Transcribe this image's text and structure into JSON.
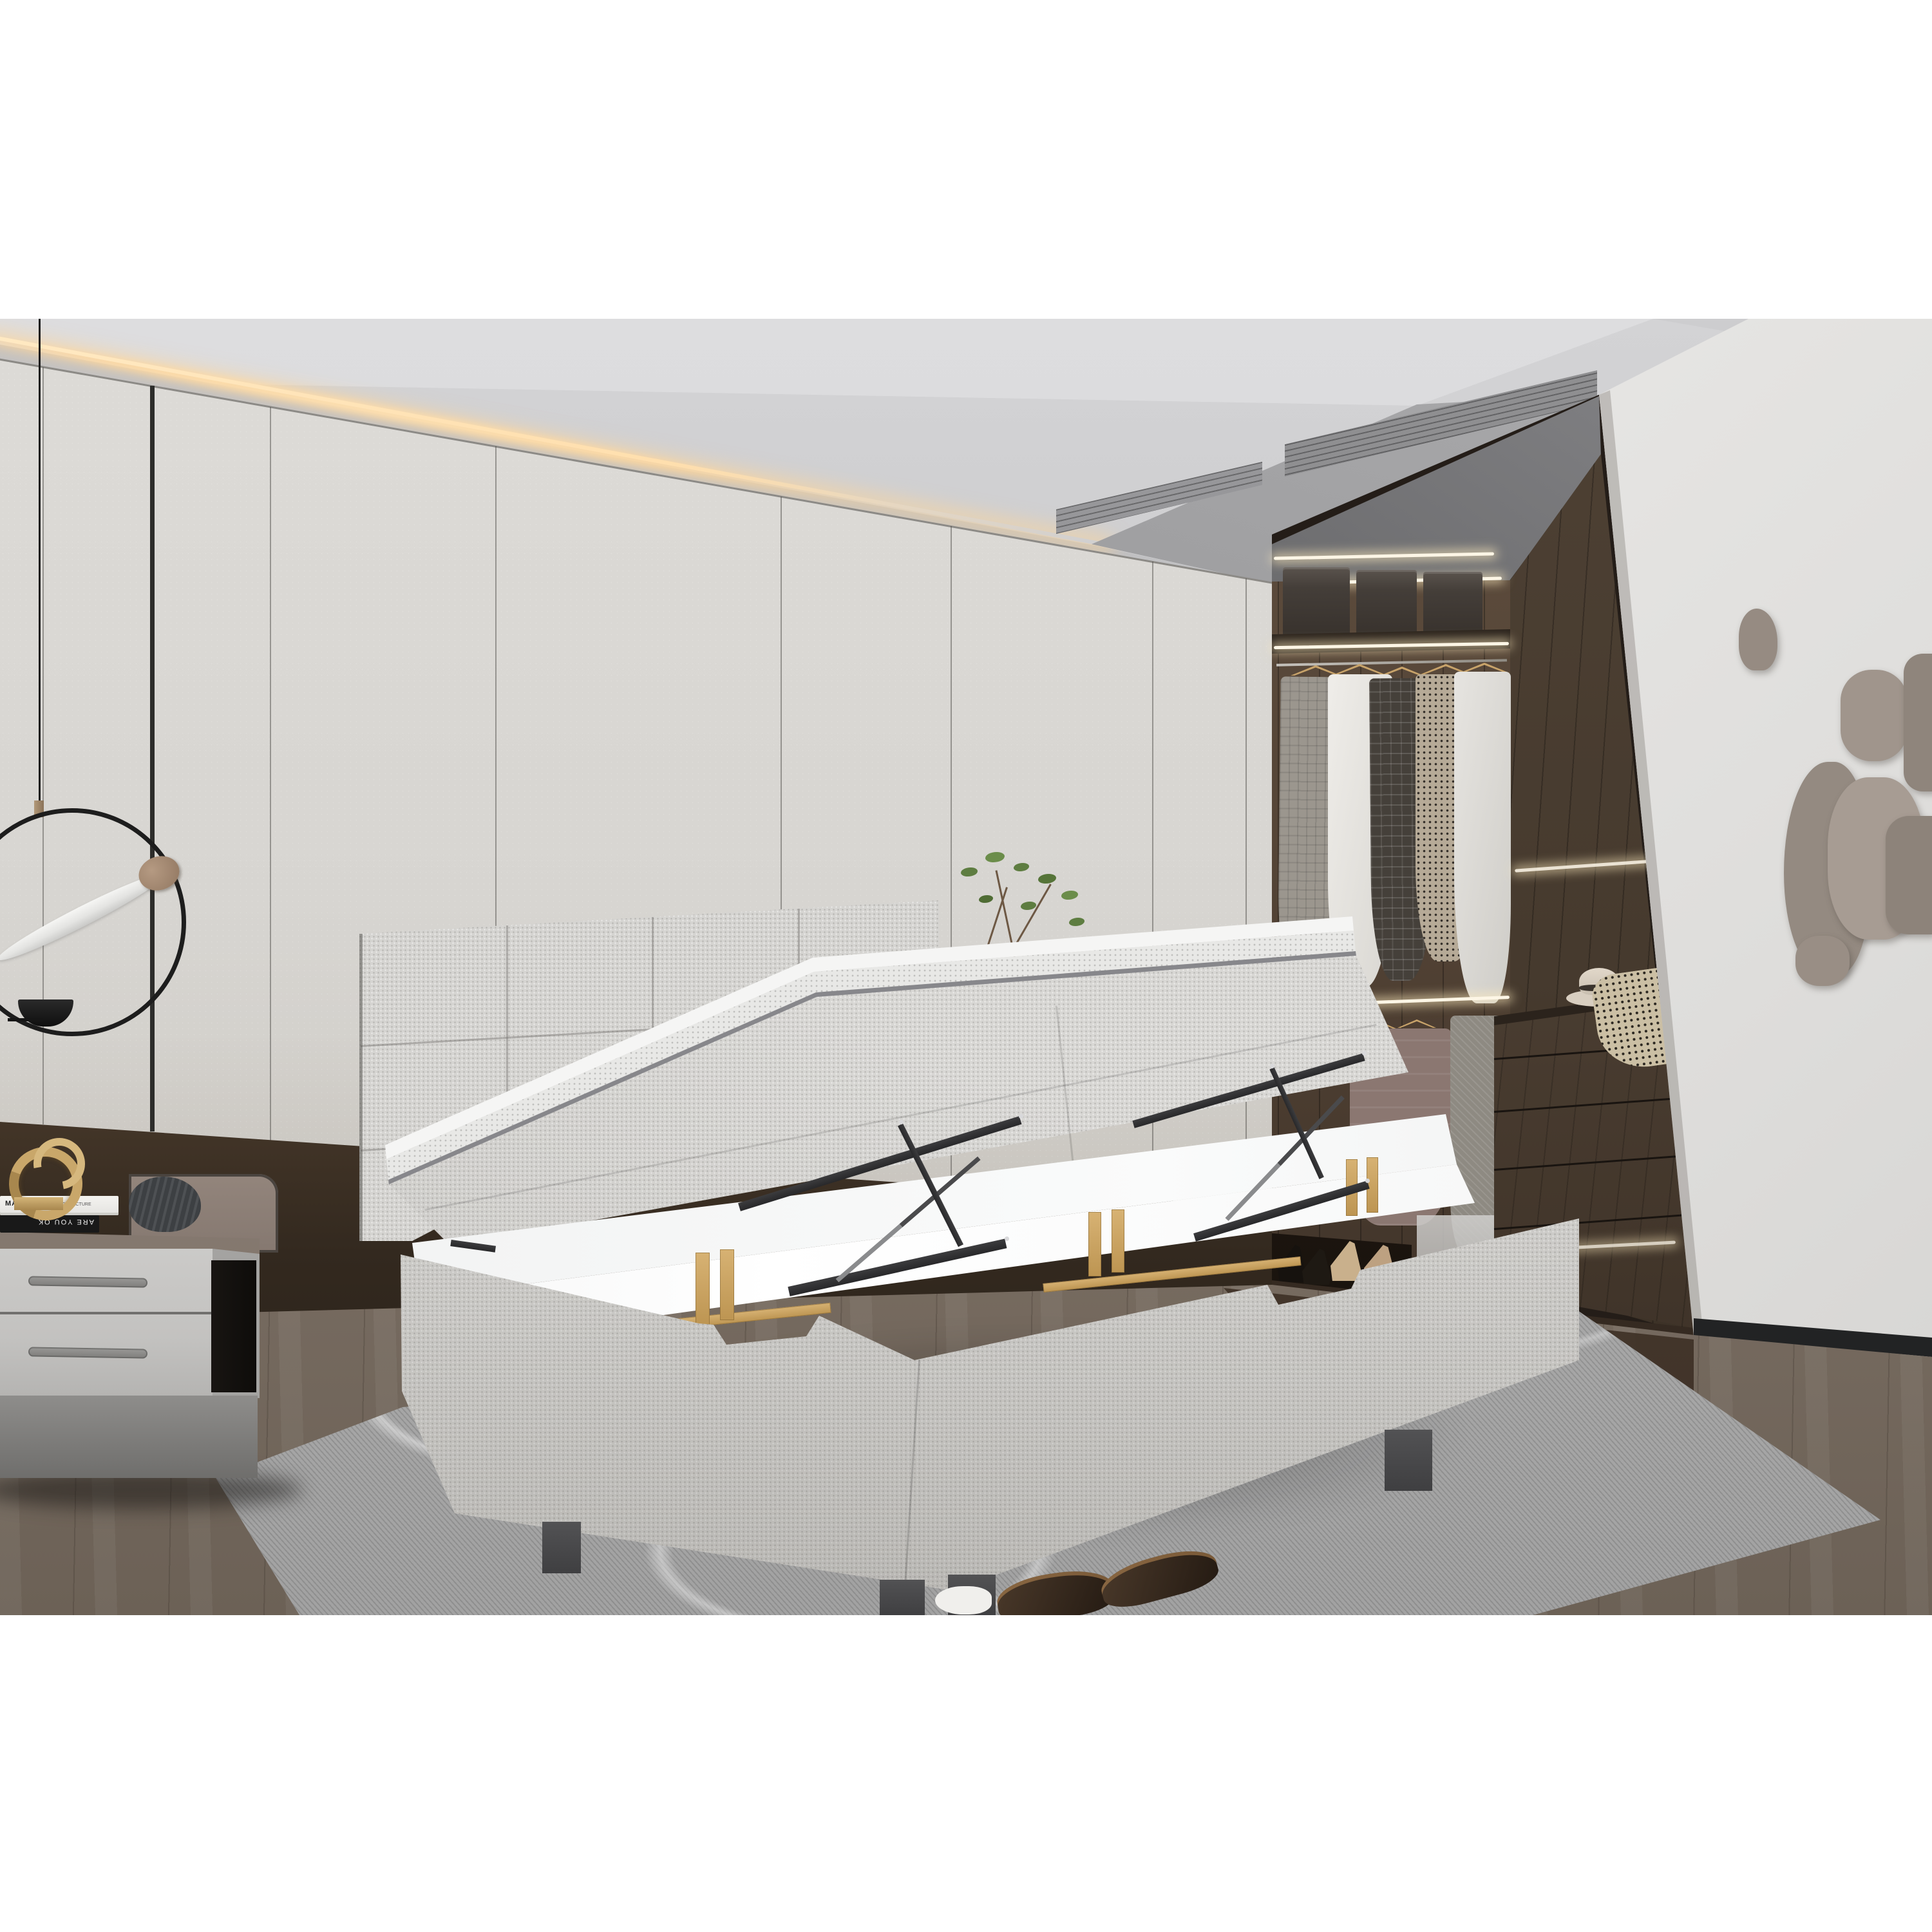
{
  "scene": {
    "type": "photorealistic interior render",
    "room": "modern bedroom with walk-in closet",
    "subject": "grey upholstered ottoman storage bed with mattress lifted open on gas struts, revealing white under-bed storage with wooden slats",
    "objects": [
      "white panelled wardrobe wall",
      "warm LED cove ceiling light",
      "linear ceiling air vent",
      "black ring pendant light with bronze disc and white blade",
      "grey nightstand with two drawers",
      "gold abstract sculpture",
      "stacked decor books",
      "dark knitted sculpture",
      "walk-in closet with dark walnut panels",
      "fabric storage boxes on upper shelf",
      "clothes on wooden hangers",
      "chest of drawers with fedora hat and houndstooth cloth",
      "high-heel shoes on low shelf",
      "taupe abstract wall art",
      "grey wood floor",
      "grey patterned area rug",
      "brown slippers",
      "green plant sprigs"
    ]
  },
  "books": {
    "black_spine": "ARE YOU OK",
    "white_spine_title": "MARK",
    "white_spine_sub": "ANOTHER ARCHITECTURE"
  },
  "palette": {
    "margin": "#ffffff",
    "wardrobe": "#d6d4cf",
    "ceiling": "#c9c9cb",
    "led_glow": "#ffd9a2",
    "closet_wood": "#51443a",
    "closet_shadow": "#241d18",
    "right_wall": "#e9e8e6",
    "baseboard": "#232425",
    "floor": "#7e7268",
    "closet_floor": "#43352b",
    "rug": "#b0b0b0",
    "bed_fabric": "#d6d5d2",
    "mattress_white": "#f4f4f3",
    "storage_interior": "#f8f9f9",
    "lift_metal": "#323234",
    "slat_wood": "#c79f5f",
    "bronze_band": "#96764f",
    "wall_art": "#9c9188",
    "gold": "#c9a76a"
  }
}
